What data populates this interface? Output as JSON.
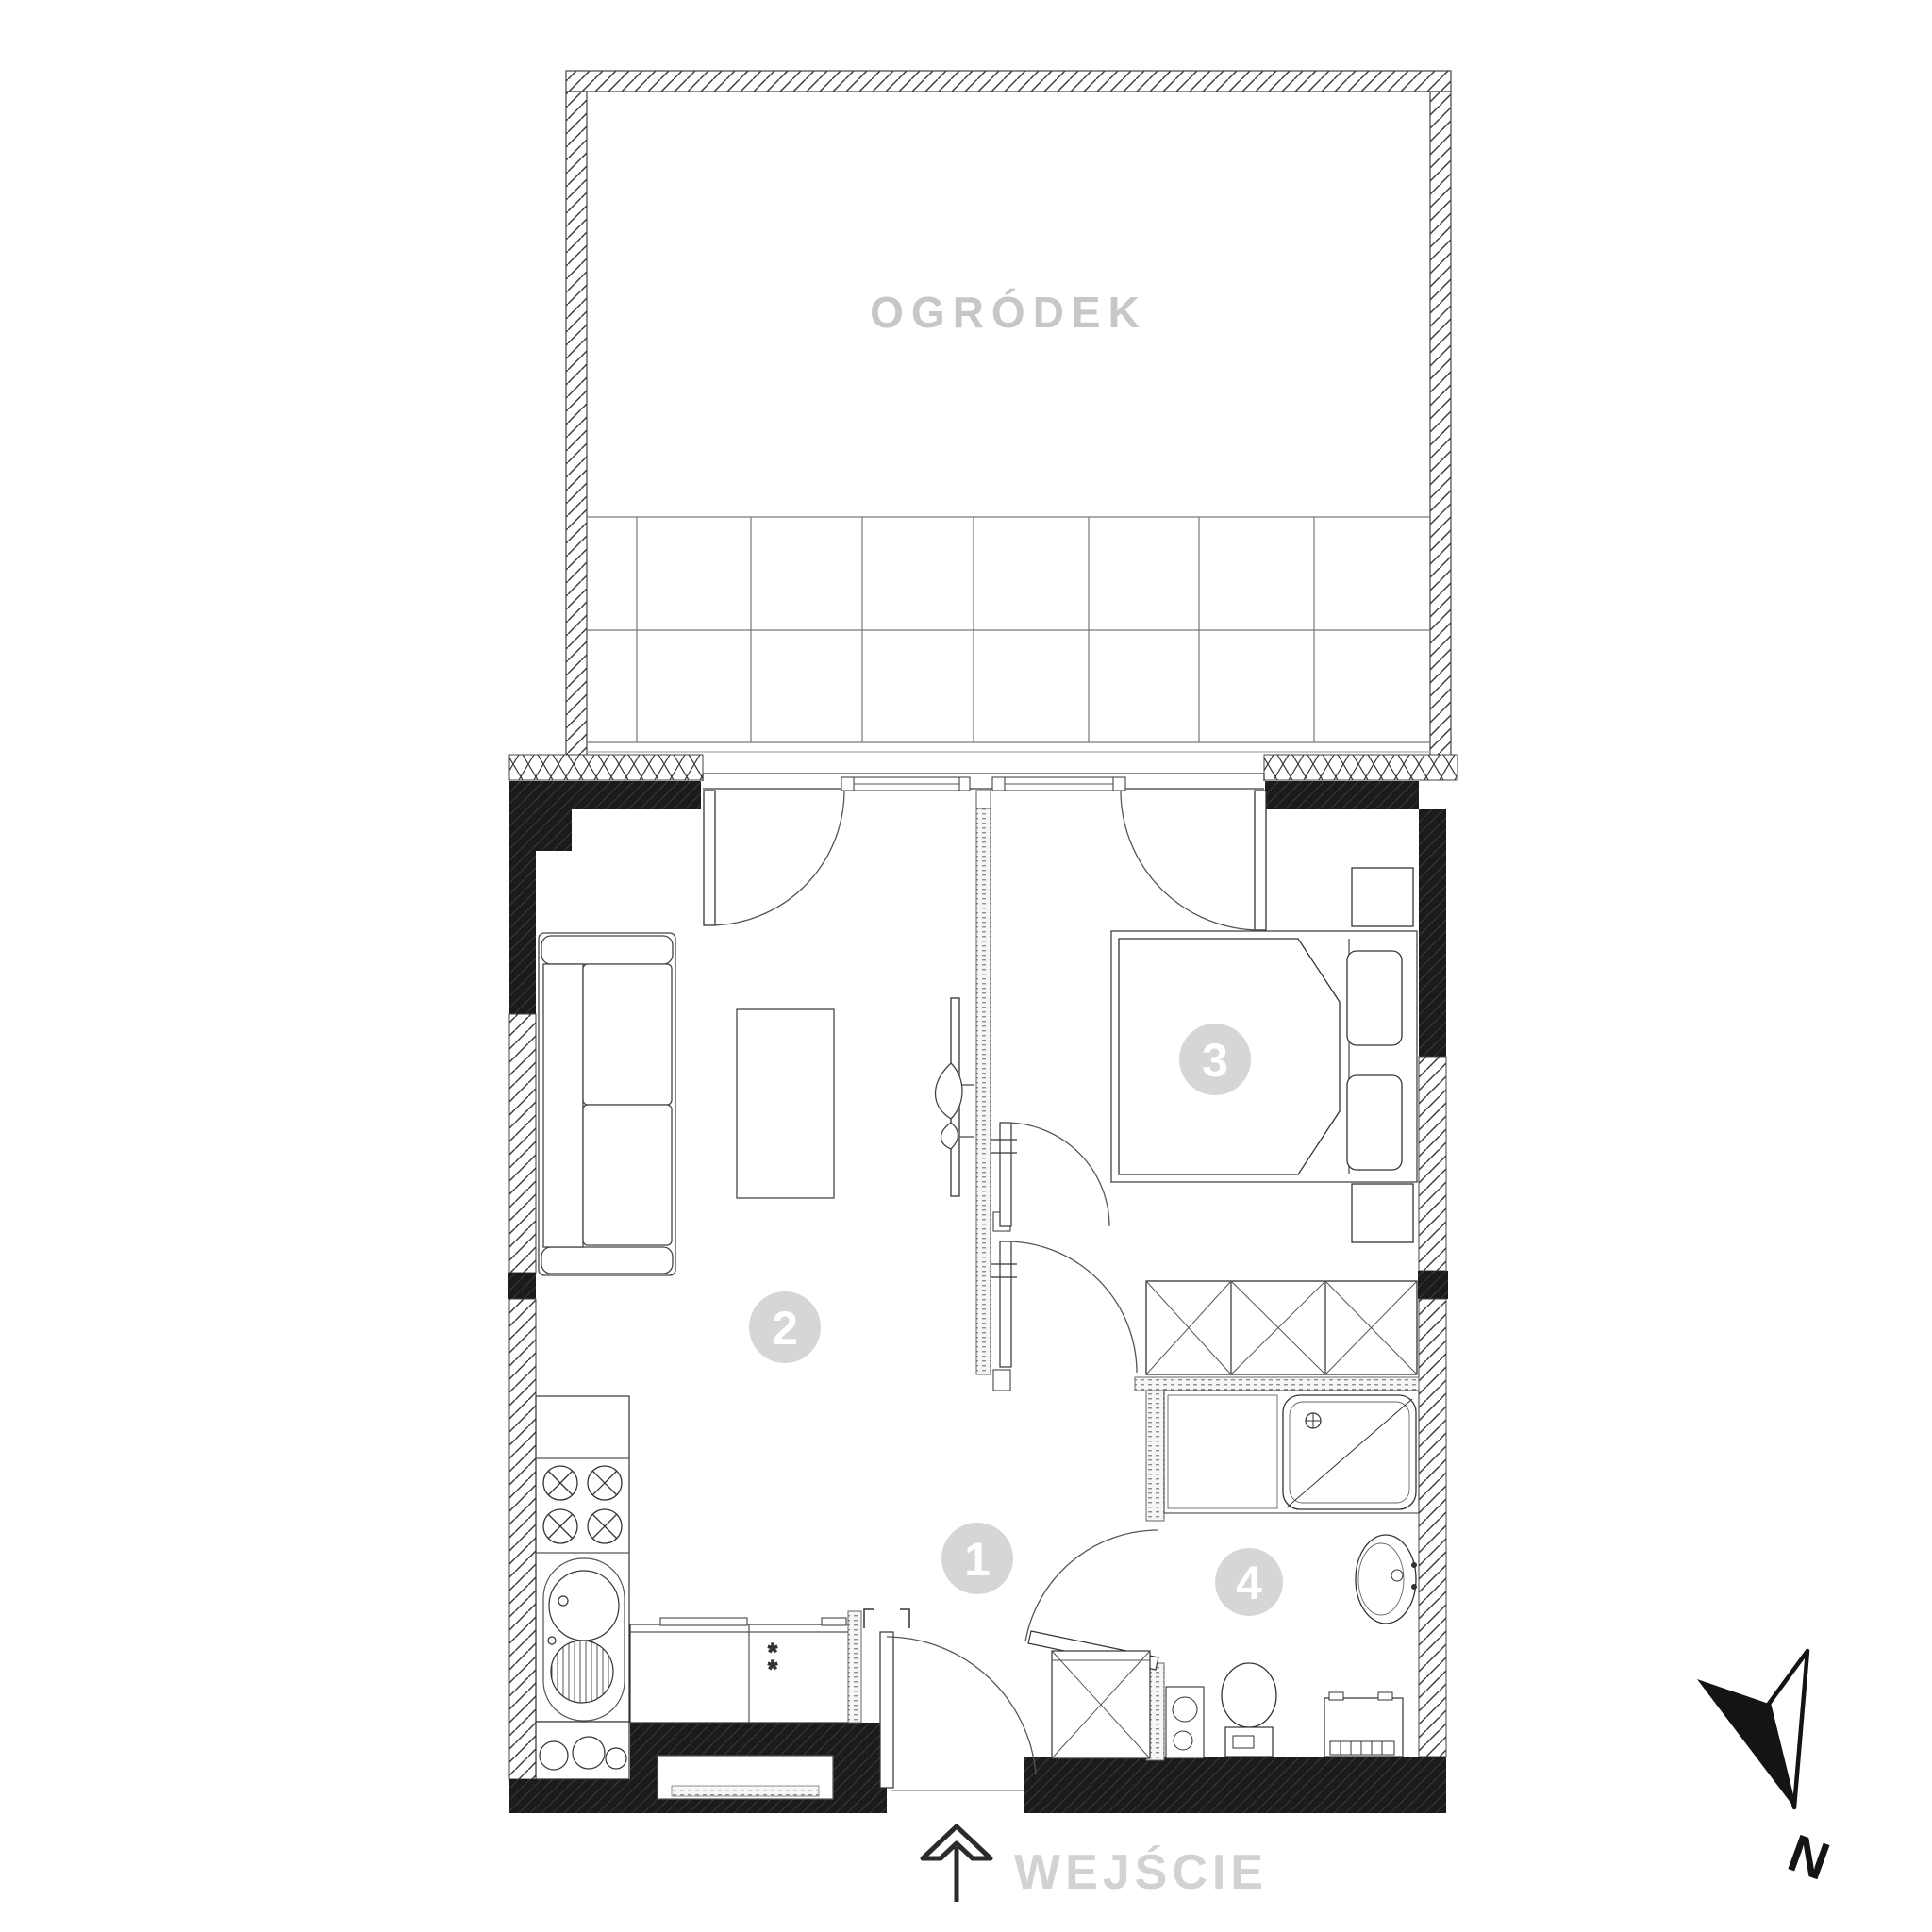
{
  "plan": {
    "garden_label": "OGRÓDEK",
    "entrance_label": "WEJŚCIE",
    "north_label": "N",
    "fridge_mark": "*",
    "rooms": [
      {
        "label": "1"
      },
      {
        "label": "2"
      },
      {
        "label": "3"
      },
      {
        "label": "4"
      }
    ],
    "colors": {
      "background": "#ffffff",
      "wall_black": "#1b1b1b",
      "hatch_line": "#3c3c3c",
      "thin_line": "#333333",
      "garden_label_gray": "#c7c7c7",
      "entrance_label_gray": "#d2d2d2",
      "badge_gray": "#d6d6d6",
      "badge_text": "#ffffff"
    }
  }
}
